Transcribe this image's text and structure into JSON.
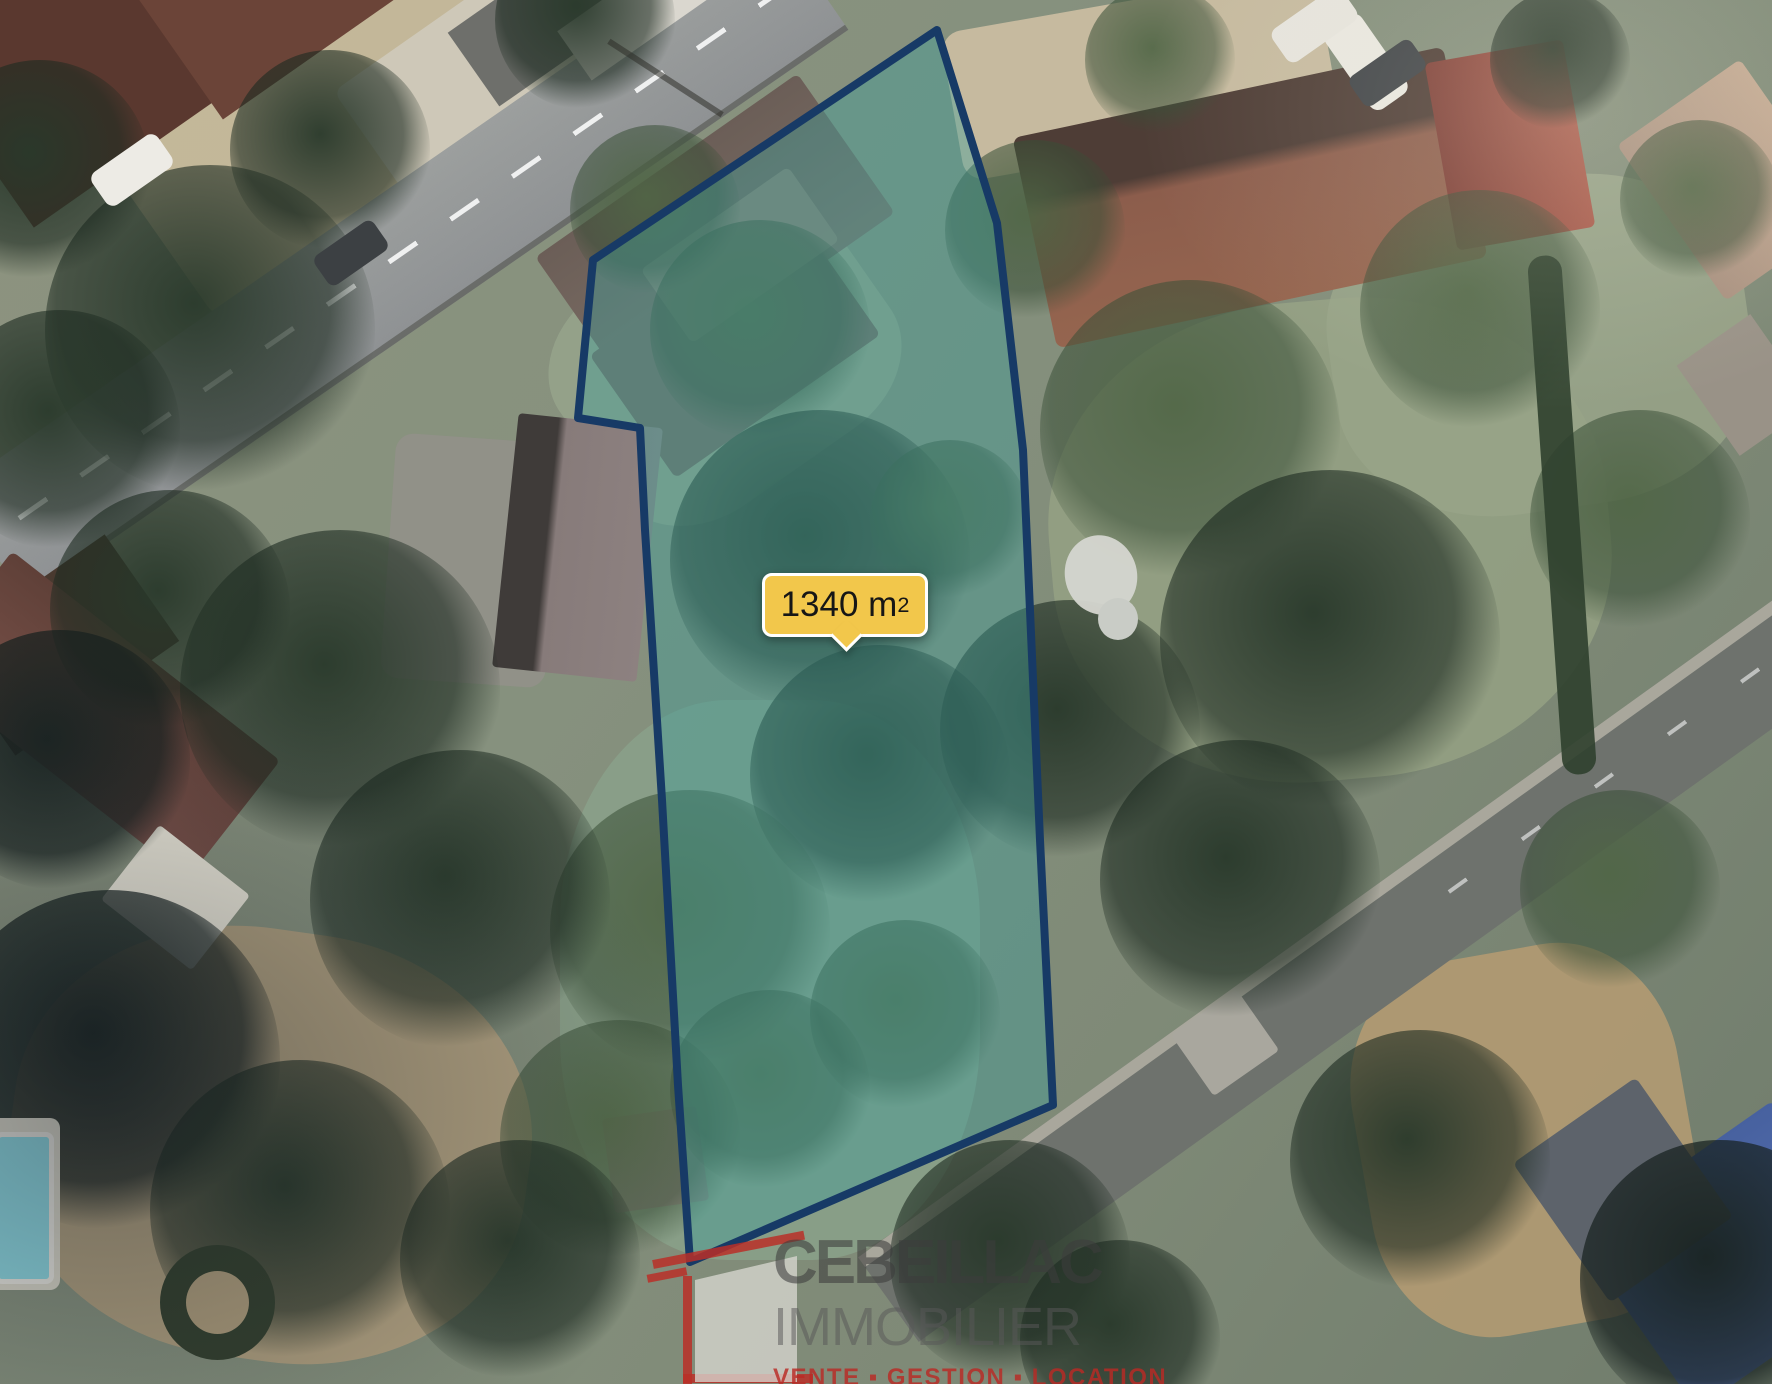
{
  "map_overlay": {
    "area_label": {
      "value": "1340 m",
      "sup": "2"
    },
    "parcel": {
      "points": "937,30 997,223 1023,450 1040,840 1053,1105 690,1262 678,1085 662,800 645,530 640,428 578,418 593,260",
      "fill": "#3d9e98",
      "fill_opacity": "0.42",
      "stroke": "#173a66",
      "stroke_width": "8"
    }
  },
  "label_style": {
    "bg": "#f2c74b",
    "border": "#ffffff",
    "text": "#161616"
  },
  "watermark": {
    "name": "CEBEILLAC",
    "sector": "IMMOBILIER",
    "tagline": "VENTE ▪ GESTION ▪ LOCATION",
    "logo_icon": "house-outline-icon",
    "logo_color": "#ba2f28",
    "name_color": "#3c3c3c",
    "tagline_color": "#ba2a24"
  }
}
